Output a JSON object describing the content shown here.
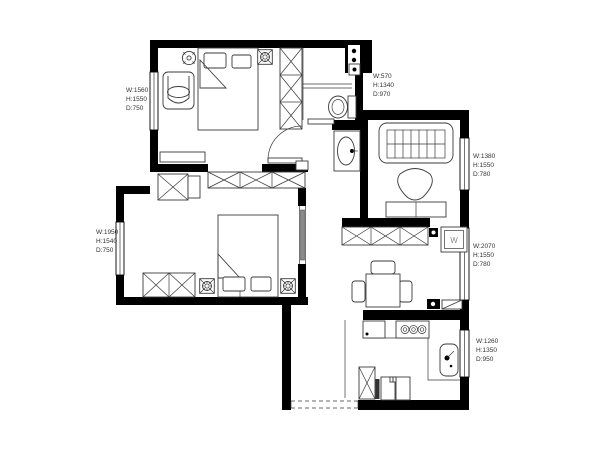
{
  "title": "apartment-floor-plan",
  "colors": {
    "wall": "#000000",
    "line": "#3a3a3a",
    "background": "#ffffff",
    "label_text": "#333333"
  },
  "dimension_labels": {
    "bedroom_top_left": {
      "w": "W:1560",
      "h": "H:1550",
      "d": "D:750"
    },
    "bathroom": {
      "w": "W:570",
      "h": "H:1340",
      "d": "D:970"
    },
    "living_room": {
      "w": "W:1380",
      "h": "H:1550",
      "d": "D:780"
    },
    "bedroom_bottom_left": {
      "w": "W:1950",
      "h": "H:1540",
      "d": "D:750"
    },
    "dining": {
      "w": "W:2070",
      "h": "H:1550",
      "d": "D:780"
    },
    "kitchen": {
      "w": "W:1260",
      "h": "H:1350",
      "d": "D:950"
    }
  },
  "appliances": {
    "washing_machine_label": "W"
  }
}
